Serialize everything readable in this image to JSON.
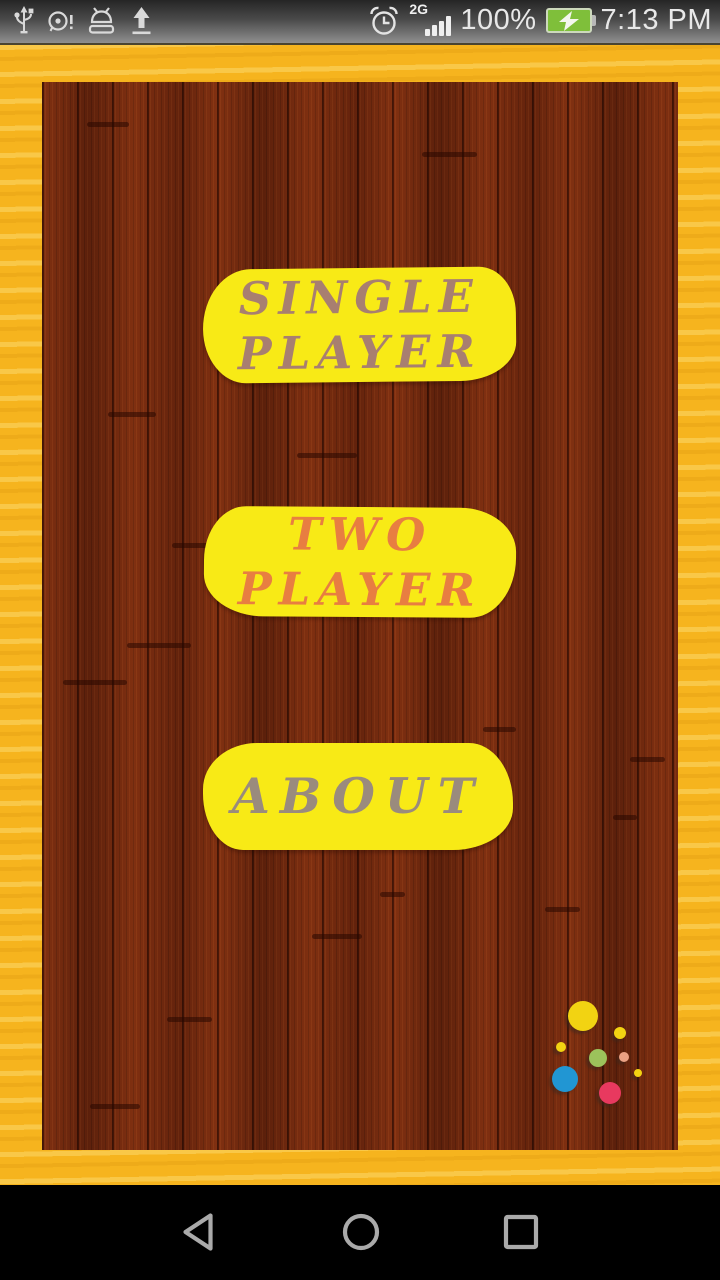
{
  "status_bar": {
    "time": "7:13 PM",
    "battery_percent": "100%",
    "network_label": "2G",
    "signal_bars": 4,
    "left_icons": [
      "usb-icon",
      "alert-circle-icon",
      "android-debug-icon",
      "upload-icon"
    ],
    "battery_color": "#7FBF3A"
  },
  "menu": {
    "button_color": "#F8EA16",
    "buttons": [
      {
        "id": "single-player",
        "lines": [
          "SINGLE",
          "PLAYER"
        ],
        "text_color": "#A87F70"
      },
      {
        "id": "two-player",
        "lines": [
          "TWO",
          "PLAYER"
        ],
        "text_color": "#E87E41"
      },
      {
        "id": "about",
        "lines": [
          "ABOUT"
        ],
        "text_color": "#9A8B7D"
      }
    ]
  },
  "theme": {
    "frame_yellow": "#F6B41E",
    "wood_brown": "#73280E",
    "navbar_black": "#000000"
  },
  "decoration": {
    "dots": [
      {
        "x": 541,
        "y": 934,
        "r": 15,
        "color": "#F2D312"
      },
      {
        "x": 578,
        "y": 951,
        "r": 6,
        "color": "#F2D312"
      },
      {
        "x": 519,
        "y": 965,
        "r": 5,
        "color": "#F2D312"
      },
      {
        "x": 556,
        "y": 976,
        "r": 9,
        "color": "#9CC25B"
      },
      {
        "x": 582,
        "y": 975,
        "r": 5,
        "color": "#EBA183"
      },
      {
        "x": 523,
        "y": 997,
        "r": 13,
        "color": "#2196D3"
      },
      {
        "x": 596,
        "y": 991,
        "r": 4,
        "color": "#F2D312"
      },
      {
        "x": 568,
        "y": 1011,
        "r": 11,
        "color": "#E8395F"
      }
    ],
    "plank_marks": [
      {
        "x": 45,
        "y": 40,
        "w": 42
      },
      {
        "x": 380,
        "y": 70,
        "w": 55
      },
      {
        "x": 66,
        "y": 330,
        "w": 48
      },
      {
        "x": 255,
        "y": 371,
        "w": 60
      },
      {
        "x": 130,
        "y": 461,
        "w": 48
      },
      {
        "x": 85,
        "y": 561,
        "w": 64
      },
      {
        "x": 21,
        "y": 598,
        "w": 64
      },
      {
        "x": 441,
        "y": 645,
        "w": 33
      },
      {
        "x": 588,
        "y": 675,
        "w": 35
      },
      {
        "x": 571,
        "y": 733,
        "w": 24
      },
      {
        "x": 338,
        "y": 810,
        "w": 25
      },
      {
        "x": 503,
        "y": 825,
        "w": 35
      },
      {
        "x": 270,
        "y": 852,
        "w": 50
      },
      {
        "x": 125,
        "y": 935,
        "w": 45
      },
      {
        "x": 48,
        "y": 1022,
        "w": 50
      }
    ]
  },
  "nav_bar": {
    "buttons": [
      "back",
      "home",
      "recents"
    ]
  }
}
